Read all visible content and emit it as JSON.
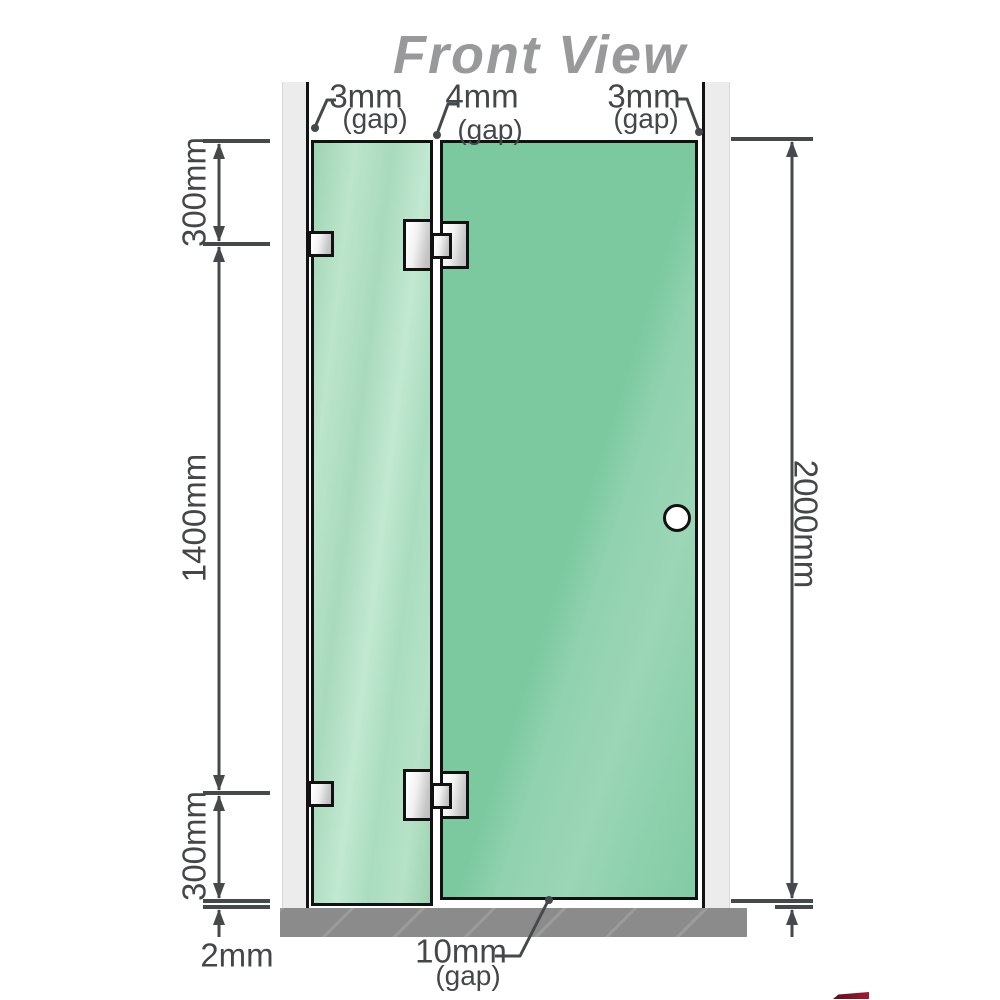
{
  "title": "Front View",
  "top_gaps": [
    {
      "value": "3mm",
      "note": "(gap)"
    },
    {
      "value": "4mm",
      "note": "(gap)"
    },
    {
      "value": "3mm",
      "note": "(gap)"
    }
  ],
  "left_dims": {
    "upper": "300mm",
    "middle": "1400mm",
    "lower": "300mm",
    "floor_gap": "2mm"
  },
  "right_dims": {
    "total_height": "2000mm"
  },
  "bottom_gap": {
    "value": "10mm",
    "note": "(gap)"
  },
  "colors": {
    "glass_door": "#7cc9a0",
    "glass_fixed": "#aedec0",
    "floor": "#8b8b8b",
    "wall_post": "#ececec",
    "hinge_metal": "#d9d9d9",
    "outline": "#121212",
    "dimension_lines": "#45494b",
    "title_text": "#98999b"
  }
}
